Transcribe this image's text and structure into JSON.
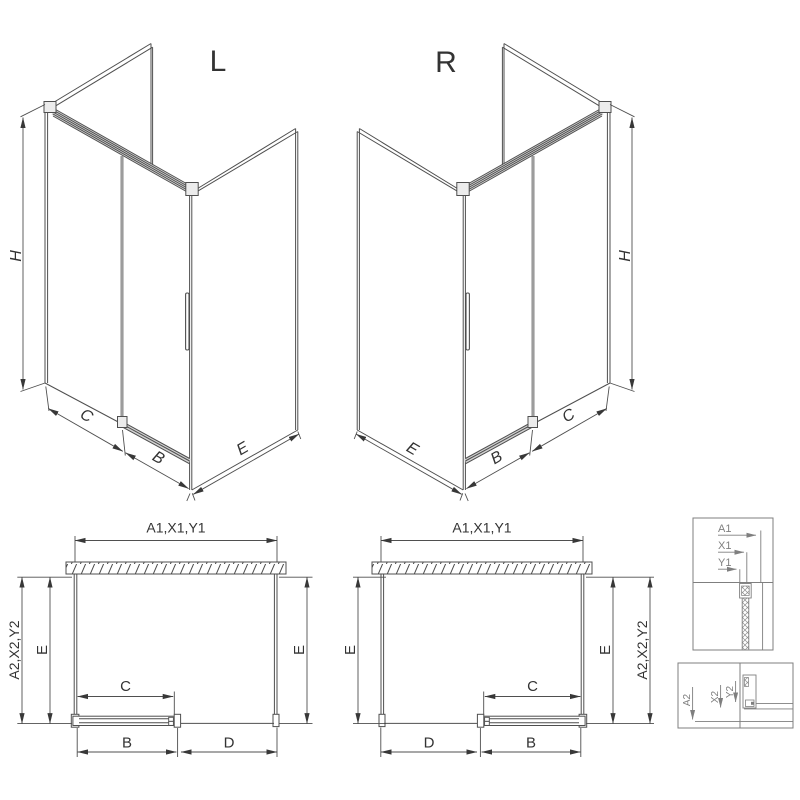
{
  "drawing": {
    "title": "Shower enclosure dimensional drawing",
    "views": {
      "iso_left": {
        "title": "L"
      },
      "iso_right": {
        "title": "R"
      }
    },
    "dims": {
      "H": "H",
      "B": "B",
      "C": "C",
      "D": "D",
      "E": "E",
      "width_codes": "A1,X1,Y1",
      "depth_codes": "A2,X2,Y2"
    },
    "detail_top": {
      "row1": "A1",
      "row2": "X1",
      "row3": "Y1"
    },
    "detail_bottom": {
      "row1": "A2",
      "row2": "X2",
      "row3": "Y2"
    },
    "colors": {
      "line": "#4f4f4f",
      "dim": "#383838",
      "detail": "#7f7f7f",
      "glass_edge": "#9c9c9c",
      "background": "#ffffff"
    }
  }
}
